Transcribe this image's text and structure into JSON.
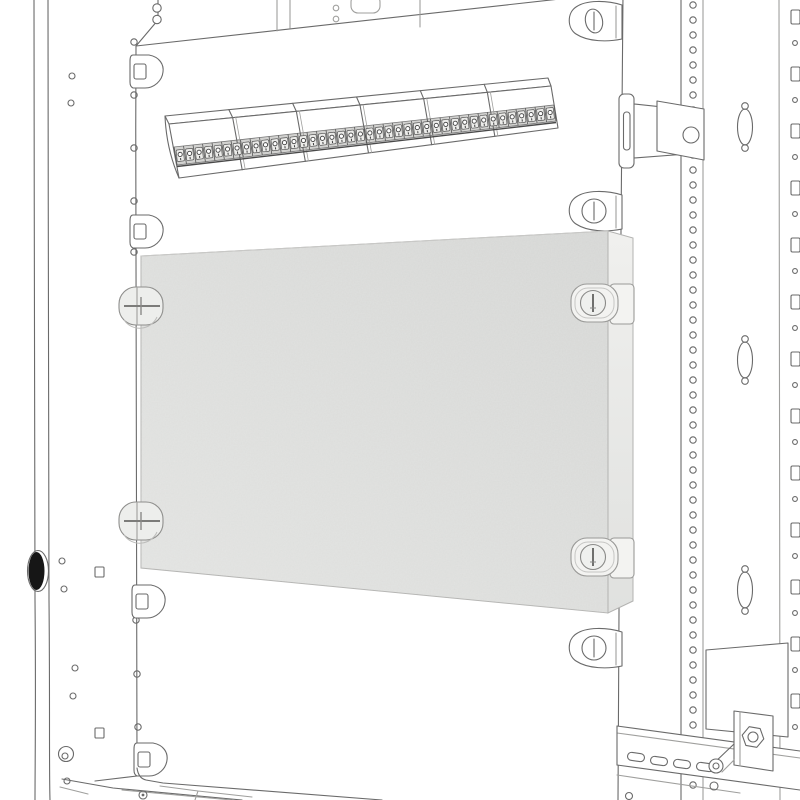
{
  "title": "Electrical enclosure technical illustration: frame with terminal strip, blind panel and DIN rail",
  "canvas": {
    "width": 800,
    "height": 800,
    "background": "#ffffff"
  },
  "style": {
    "line_color": "#6a6a6a",
    "line_soft": "#9f9f9d",
    "panel_face_light": "#e1e2e0",
    "panel_face_dark": "#d4d5d3",
    "panel_edge_light": "#f0f0ee",
    "panel_edge_dark": "#e0e1df",
    "fastener_fill": "#f3f3f1",
    "knob_fill": "#edeeec",
    "terminal_dark": "#3f3f3f",
    "knockout_fill": "#161616"
  },
  "components": {
    "cabinet_left_wall": {
      "knockout_count": 1
    },
    "frame": {
      "left_clip_count": 4,
      "right_tab_count": 3,
      "edge_hole_count": 8
    },
    "terminal_strip": {
      "module_count": 6,
      "terminal_count": 40
    },
    "blind_panel": {
      "left_knob_count": 2,
      "right_clamp_count": 2
    },
    "right_uprights": {
      "inner_hole_count": 53,
      "keyhole_count": 3,
      "outer_slot_count": 14
    },
    "din_rail": {
      "slot_count": 4,
      "hex_bolt_count": 1,
      "screw_count": 1
    }
  },
  "patterns": {
    "left_wall_holes": [
      [
        72,
        76
      ],
      [
        71,
        103
      ],
      [
        62,
        561
      ],
      [
        64,
        589
      ],
      [
        75,
        668
      ],
      [
        73,
        696
      ],
      [
        67,
        781
      ]
    ],
    "left_wall_squares": [
      [
        95,
        567
      ],
      [
        95,
        728
      ]
    ],
    "left_wall_ring": [
      66,
      754
    ],
    "frame_edge_holes": [
      [
        134,
        42
      ],
      [
        134,
        95
      ],
      [
        134,
        148
      ],
      [
        134,
        201
      ],
      [
        134,
        252
      ],
      [
        136,
        620
      ],
      [
        137,
        674
      ],
      [
        138,
        727
      ]
    ],
    "left_clips": {
      "x": [
        130,
        130,
        132,
        134
      ],
      "y": [
        55,
        215,
        585,
        743
      ]
    },
    "right_tabs_y": [
      2,
      192,
      629
    ],
    "inner_rail": {
      "x": 693,
      "r": 3.2,
      "y0": 5,
      "step": 15,
      "count": 53
    },
    "keyholes": {
      "x": 745,
      "centers_y": [
        127,
        360,
        590
      ]
    },
    "outer_rail": {
      "rect_x": 791,
      "rect_w": 9,
      "rect_h": 14,
      "y0": 10,
      "step": 57,
      "count": 14,
      "dot_x": 795,
      "dot_r": 2.4
    },
    "din_slots": {
      "centers": [
        [
          636,
          757
        ],
        [
          659,
          761
        ],
        [
          682,
          764
        ],
        [
          705,
          767
        ]
      ],
      "w": 17,
      "h": 8,
      "angle": 8
    },
    "terminal_strip": {
      "module_count": 6,
      "terminal_count": 40,
      "top_back": [
        [
          165,
          116
        ],
        [
          548,
          78
        ]
      ],
      "top_front": [
        [
          169,
          124
        ],
        [
          551,
          86
        ]
      ],
      "band_top": [
        [
          174,
          147
        ],
        [
          554,
          105
        ]
      ],
      "band_bottom": [
        [
          177,
          165
        ],
        [
          556,
          121
        ]
      ],
      "bottom": [
        [
          179,
          178
        ],
        [
          558,
          128
        ]
      ]
    }
  }
}
